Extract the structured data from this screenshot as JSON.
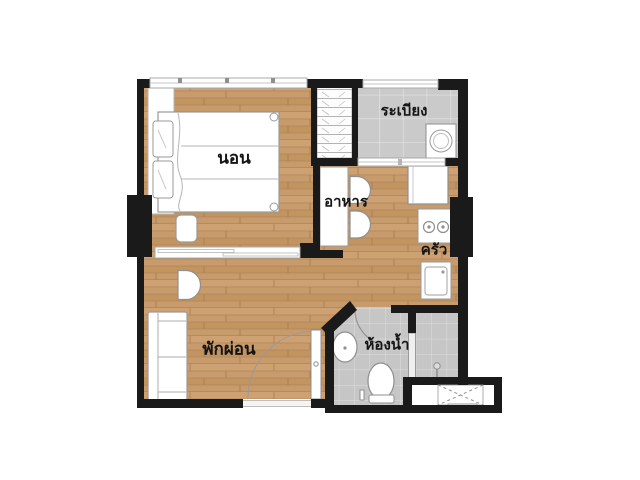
{
  "title": "apartment-floor-plan",
  "floor_plan": {
    "rooms": {
      "bedroom": {
        "label": "นอน"
      },
      "balcony": {
        "label": "ระเบียง"
      },
      "dining": {
        "label": "อาหาร"
      },
      "kitchen": {
        "label": "ครัว"
      },
      "living": {
        "label": "พักผ่อน"
      },
      "bathroom": {
        "label": "ห้องน้ำ"
      }
    },
    "fixtures": [
      "double-bed",
      "pillows",
      "nightstand",
      "wardrobe",
      "sliding-partition",
      "washing-machine",
      "balcony-railing",
      "dining-table",
      "dining-chair",
      "dining-chair",
      "refrigerator",
      "stove-2-burners",
      "kitchen-sink",
      "armchair",
      "sofa",
      "entrance-door-swing",
      "wash-basin",
      "toilet",
      "shower",
      "shower-glass-partition",
      "ac-ledge-cross",
      "structural-column",
      "structural-column",
      "bedroom-window"
    ],
    "colors": {
      "wall": "#1a1a1a",
      "wood_floor": "#c79a6b",
      "tile_floor": "#c9c9c9",
      "fixture_fill": "#ffffff",
      "fixture_stroke": "#9a9a9a"
    }
  }
}
